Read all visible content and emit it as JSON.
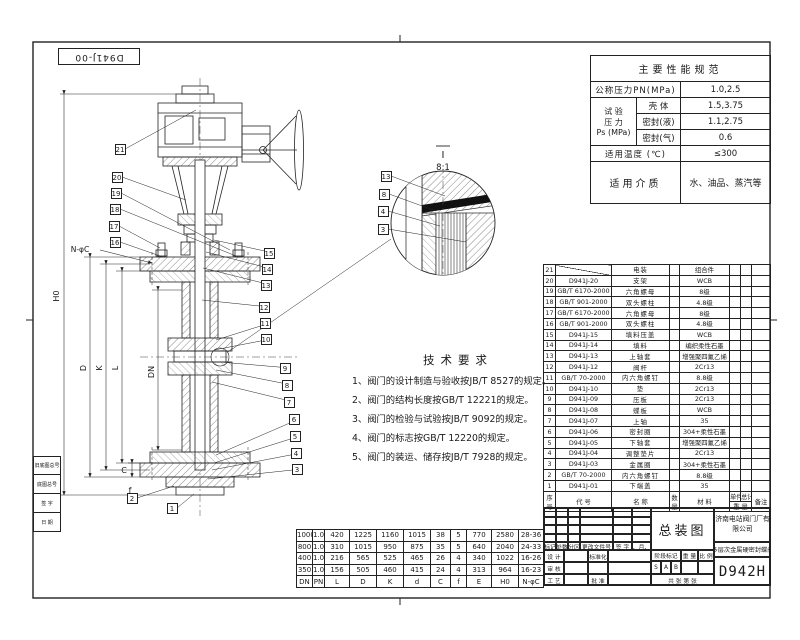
{
  "corner_label": "D941J-00",
  "spec_table": {
    "title": "主要性能规范",
    "nominal_pressure_label": "公称压力PN(MPa)",
    "nominal_pressure_value": "1.0,2.5",
    "test_pressure_label1": "试 验",
    "test_pressure_label2": "压 力",
    "test_pressure_label3": "Ps (MPa)",
    "test_rows": [
      {
        "label": "壳 体",
        "value": "1.5,3.75"
      },
      {
        "label": "密封(液)",
        "value": "1.1,2.75"
      },
      {
        "label": "密封(气)",
        "value": "0.6"
      }
    ],
    "temp_label": "适用温度 (℃)",
    "temp_value": "≤300",
    "medium_label": "适用介质",
    "medium_value": "水、油品、蒸汽等"
  },
  "tech_requirements": {
    "title": "技术要求",
    "items": [
      "1、阀门的设计制造与验收按JB/T 8527的规定。",
      "2、阀门的结构长度按GB/T 12221的规定。",
      "3、阀门的检验与试验按JB/T 9092的规定。",
      "4、阀门的标志按GB/T 12220的规定。",
      "5、阀门的装运、储存按JB/T 7928的规定。"
    ]
  },
  "parts_list": {
    "header": {
      "no": "序号",
      "code": "代 号",
      "name": "名 称",
      "qty": "数量",
      "material": "材 料",
      "unit": "单件",
      "total": "总计",
      "weight": "重 量",
      "remark": "备注"
    },
    "rows": [
      {
        "no": "21",
        "code": "",
        "name": "电装",
        "qty": "",
        "material": "组合件"
      },
      {
        "no": "20",
        "code": "D941J-20",
        "name": "支架",
        "qty": "",
        "material": "WCB"
      },
      {
        "no": "19",
        "code": "GB/T 6170-2000",
        "name": "六角螺母",
        "qty": "",
        "material": "8级"
      },
      {
        "no": "18",
        "code": "GB/T 901-2000",
        "name": "双头螺柱",
        "qty": "",
        "material": "4.8级"
      },
      {
        "no": "17",
        "code": "GB/T 6170-2000",
        "name": "六角螺母",
        "qty": "",
        "material": "8级"
      },
      {
        "no": "16",
        "code": "GB/T 901-2000",
        "name": "双头螺柱",
        "qty": "",
        "material": "4.8级"
      },
      {
        "no": "15",
        "code": "D941J-15",
        "name": "填料压盖",
        "qty": "",
        "material": "WCB"
      },
      {
        "no": "14",
        "code": "D941J-14",
        "name": "填料",
        "qty": "",
        "material": "编织柔性石墨"
      },
      {
        "no": "13",
        "code": "D941J-13",
        "name": "上轴套",
        "qty": "",
        "material": "增强聚四氟乙烯"
      },
      {
        "no": "12",
        "code": "D941J-12",
        "name": "阀杆",
        "qty": "",
        "material": "2Cr13"
      },
      {
        "no": "11",
        "code": "GB/T 70-2000",
        "name": "内六角螺钉",
        "qty": "",
        "material": "8.8级"
      },
      {
        "no": "10",
        "code": "D941J-10",
        "name": "垫",
        "qty": "",
        "material": "2Cr13"
      },
      {
        "no": "9",
        "code": "D941J-09",
        "name": "压板",
        "qty": "",
        "material": "2Cr13"
      },
      {
        "no": "8",
        "code": "D941J-08",
        "name": "蝶板",
        "qty": "",
        "material": "WCB"
      },
      {
        "no": "7",
        "code": "D941J-07",
        "name": "上轴",
        "qty": "",
        "material": "35"
      },
      {
        "no": "6",
        "code": "D941J-06",
        "name": "密封圈",
        "qty": "",
        "material": "304+柔性石墨"
      },
      {
        "no": "5",
        "code": "D941J-05",
        "name": "下轴套",
        "qty": "",
        "material": "增强聚四氟乙烯"
      },
      {
        "no": "4",
        "code": "D941J-04",
        "name": "调整垫片",
        "qty": "",
        "material": "2Cr13"
      },
      {
        "no": "3",
        "code": "D941J-03",
        "name": "金属圈",
        "qty": "",
        "material": "304+柔性石墨"
      },
      {
        "no": "2",
        "code": "GB/T 70-2000",
        "name": "内六角螺钉",
        "qty": "",
        "material": "8.8级"
      },
      {
        "no": "1",
        "code": "D941J-01",
        "name": "下端盖",
        "qty": "",
        "material": "35"
      }
    ]
  },
  "dim_table": {
    "headers": [
      "DN",
      "PN",
      "L",
      "D",
      "K",
      "d",
      "C",
      "f",
      "E",
      "H0",
      "N-φC"
    ],
    "rows": [
      [
        "1000",
        "1.0",
        "420",
        "1225",
        "1160",
        "1015",
        "38",
        "5",
        "770",
        "2580",
        "28-36"
      ],
      [
        "800",
        "1.0",
        "310",
        "1015",
        "950",
        "875",
        "35",
        "5",
        "640",
        "2040",
        "24-33"
      ],
      [
        "400",
        "1.0",
        "216",
        "565",
        "525",
        "465",
        "26",
        "4",
        "340",
        "1022",
        "16-26"
      ],
      [
        "350",
        "1.0",
        "156",
        "505",
        "460",
        "415",
        "24",
        "4",
        "313",
        "964",
        "16-23"
      ]
    ]
  },
  "title_block": {
    "title": "总装图",
    "company": "济南电站阀门厂有限公司",
    "product": "多层次金属硬密封蝶阀",
    "model": "D942H",
    "mark": "标记",
    "count": "处数",
    "zone": "分区",
    "change_no": "更改文件号",
    "sign": "签 字",
    "date": "年、月、日",
    "design": "设 计",
    "standard": "标准化",
    "stage": "阶段标记",
    "weight": "重 量",
    "scale": "比 例",
    "check": "审 核",
    "craft": "工 艺",
    "approve": "批 准",
    "stage_marks": [
      "S",
      "A",
      "B"
    ],
    "sheets": "共  张  第  张"
  },
  "margin_block": {
    "items": [
      "旧底图总号",
      "底图总号",
      "签 字",
      "日 期"
    ]
  },
  "detail_view": {
    "label": "Ⅰ",
    "scale": "8:1"
  },
  "drawing_dims": {
    "h0": "H0",
    "d": "D",
    "k": "K",
    "l": "L",
    "dn": "DN",
    "c": "C",
    "f": "f",
    "bolt_callout": "N-φC"
  },
  "balloons": [
    {
      "n": "21",
      "x": 120,
      "y": 149,
      "tx": 196,
      "ty": 110
    },
    {
      "n": "20",
      "x": 117,
      "y": 177,
      "tx": 186,
      "ty": 200
    },
    {
      "n": "19",
      "x": 116,
      "y": 193,
      "tx": 230,
      "ty": 250
    },
    {
      "n": "18",
      "x": 115,
      "y": 209,
      "tx": 236,
      "ty": 256
    },
    {
      "n": "17",
      "x": 114,
      "y": 226,
      "tx": 160,
      "ty": 248
    },
    {
      "n": "16",
      "x": 115,
      "y": 242,
      "tx": 163,
      "ty": 257
    },
    {
      "n": "15",
      "x": 269,
      "y": 253,
      "tx": 214,
      "ty": 240
    },
    {
      "n": "14",
      "x": 267,
      "y": 269,
      "tx": 206,
      "ty": 252
    },
    {
      "n": "13",
      "x": 266,
      "y": 285,
      "tx": 203,
      "ty": 268
    },
    {
      "n": "12",
      "x": 264,
      "y": 307,
      "tx": 202,
      "ty": 300
    },
    {
      "n": "11",
      "x": 265,
      "y": 323,
      "tx": 216,
      "ty": 340
    },
    {
      "n": "10",
      "x": 266,
      "y": 339,
      "tx": 214,
      "ty": 350
    },
    {
      "n": "9",
      "x": 285,
      "y": 368,
      "tx": 220,
      "ty": 362
    },
    {
      "n": "8",
      "x": 287,
      "y": 385,
      "tx": 216,
      "ty": 370
    },
    {
      "n": "7",
      "x": 289,
      "y": 402,
      "tx": 212,
      "ty": 382
    },
    {
      "n": "6",
      "x": 294,
      "y": 419,
      "tx": 216,
      "ty": 455
    },
    {
      "n": "5",
      "x": 295,
      "y": 436,
      "tx": 214,
      "ty": 463
    },
    {
      "n": "4",
      "x": 296,
      "y": 453,
      "tx": 212,
      "ty": 470
    },
    {
      "n": "3",
      "x": 297,
      "y": 469,
      "tx": 208,
      "ty": 479
    },
    {
      "n": "2",
      "x": 132,
      "y": 498,
      "tx": 174,
      "ty": 486
    },
    {
      "n": "1",
      "x": 172,
      "y": 508,
      "tx": 194,
      "ty": 494
    },
    {
      "n": "13",
      "x": 386,
      "y": 176,
      "tx": 445,
      "ty": 196
    },
    {
      "n": "8",
      "x": 384,
      "y": 194,
      "tx": 436,
      "ty": 211
    },
    {
      "n": "4",
      "x": 383,
      "y": 211,
      "tx": 440,
      "ty": 226
    },
    {
      "n": "3",
      "x": 383,
      "y": 229,
      "tx": 466,
      "ty": 242
    }
  ]
}
